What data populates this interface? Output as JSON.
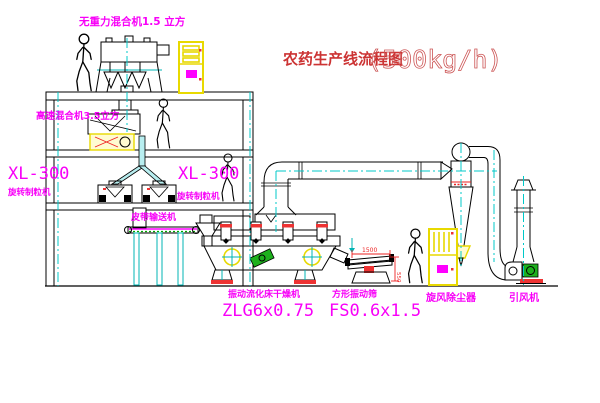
{
  "title": {
    "text": "农药生产线流程图",
    "capacity": "(500kg/h)"
  },
  "equipment": {
    "top_mixer": {
      "label": "无重力混合机1.5 立方"
    },
    "second_mixer": {
      "label": "高速混合机3.5立方"
    },
    "granulator_left": {
      "model": "XL-300",
      "name": "旋转制粒机"
    },
    "granulator_mid": {
      "model": "XL-300",
      "name": "旋转制粒机"
    },
    "belt_conveyor": {
      "name": "皮带输送机"
    },
    "dryer": {
      "name": "振动流化床干燥机",
      "model": "ZLG6x0.75"
    },
    "sieve": {
      "name": "方形振动筛",
      "model": "FS0.6x1.5",
      "dim_width": "1500",
      "dim_height": "550"
    },
    "cyclone": {
      "name": "旋风除尘器"
    },
    "fan": {
      "name": "引风机"
    }
  },
  "colors": {
    "label_magenta": "#F800F8",
    "title_red": "#CC3333",
    "centerline_cyan": "#00C8C8",
    "cabinet_yellow": "#E8D900",
    "accent_red": "#EE2222",
    "motor_green": "#1DB01D"
  }
}
